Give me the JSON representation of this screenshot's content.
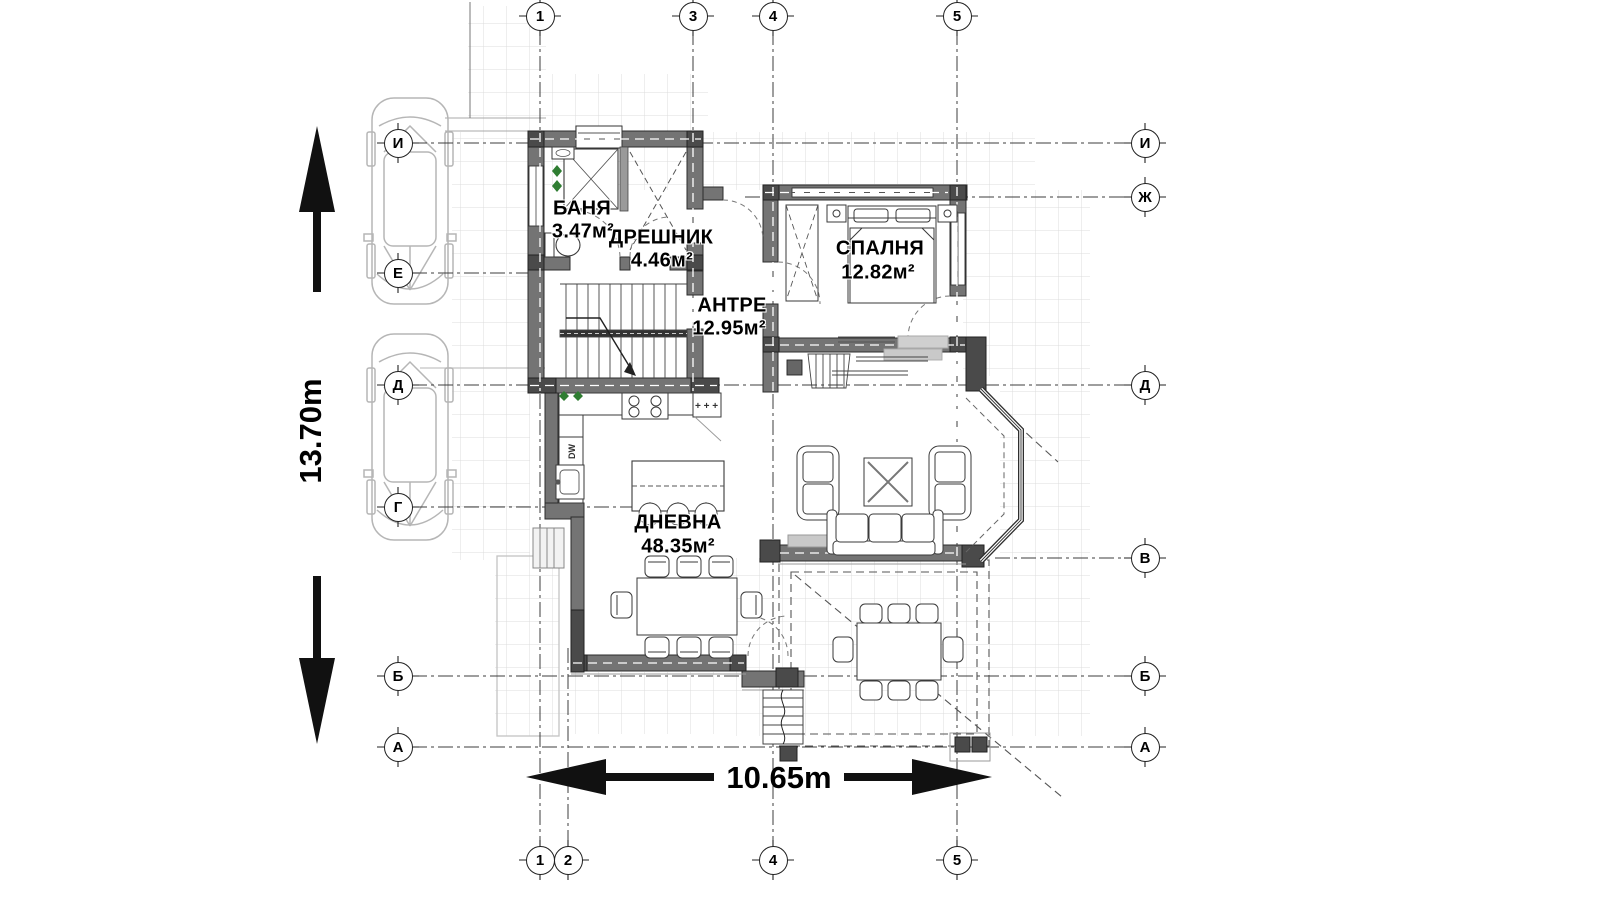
{
  "plan": {
    "rooms": [
      {
        "name": "БАНЯ",
        "area": "3.47м²"
      },
      {
        "name": "ДРЕШНИК",
        "area": "4.46м²"
      },
      {
        "name": "АНТРЕ",
        "area": "12.95м²"
      },
      {
        "name": "СПАЛНЯ",
        "area": "12.82м²"
      },
      {
        "name": "ДНЕВНА",
        "area": "48.35м²"
      }
    ],
    "dimensions": {
      "height": "13.70m",
      "width": "10.65m"
    },
    "axes": {
      "top": [
        "1",
        "3",
        "4",
        "5"
      ],
      "bottom": [
        "1",
        "2",
        "4",
        "5"
      ],
      "left": [
        "И",
        "Е",
        "Д",
        "Г",
        "Б",
        "А"
      ],
      "right": [
        "И",
        "Ж",
        "Д",
        "В",
        "Б",
        "А"
      ]
    },
    "labels": {
      "dishwasher": "DW",
      "fridge_marks": "+ + +"
    }
  }
}
